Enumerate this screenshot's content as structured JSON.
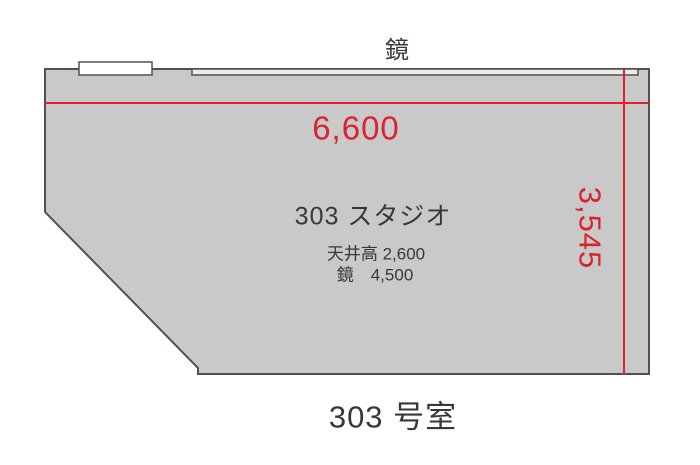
{
  "floor_plan": {
    "mirror_wall_label": "鏡",
    "dimension_width": "6,600",
    "dimension_height": "3,545",
    "studio_info": {
      "name": "303 スタジオ",
      "ceiling": "天井高 2,600",
      "mirror": "鏡　4,500"
    },
    "room_number": "303 号室",
    "colors": {
      "room_fill": "#c9c9c9",
      "wall_stroke": "#55504b",
      "dimension_red": "#d9242c",
      "text_dark": "#3b3734",
      "mirror_fill": "#ebebeb",
      "door_fill": "#ffffff",
      "background": "#ffffff"
    }
  }
}
